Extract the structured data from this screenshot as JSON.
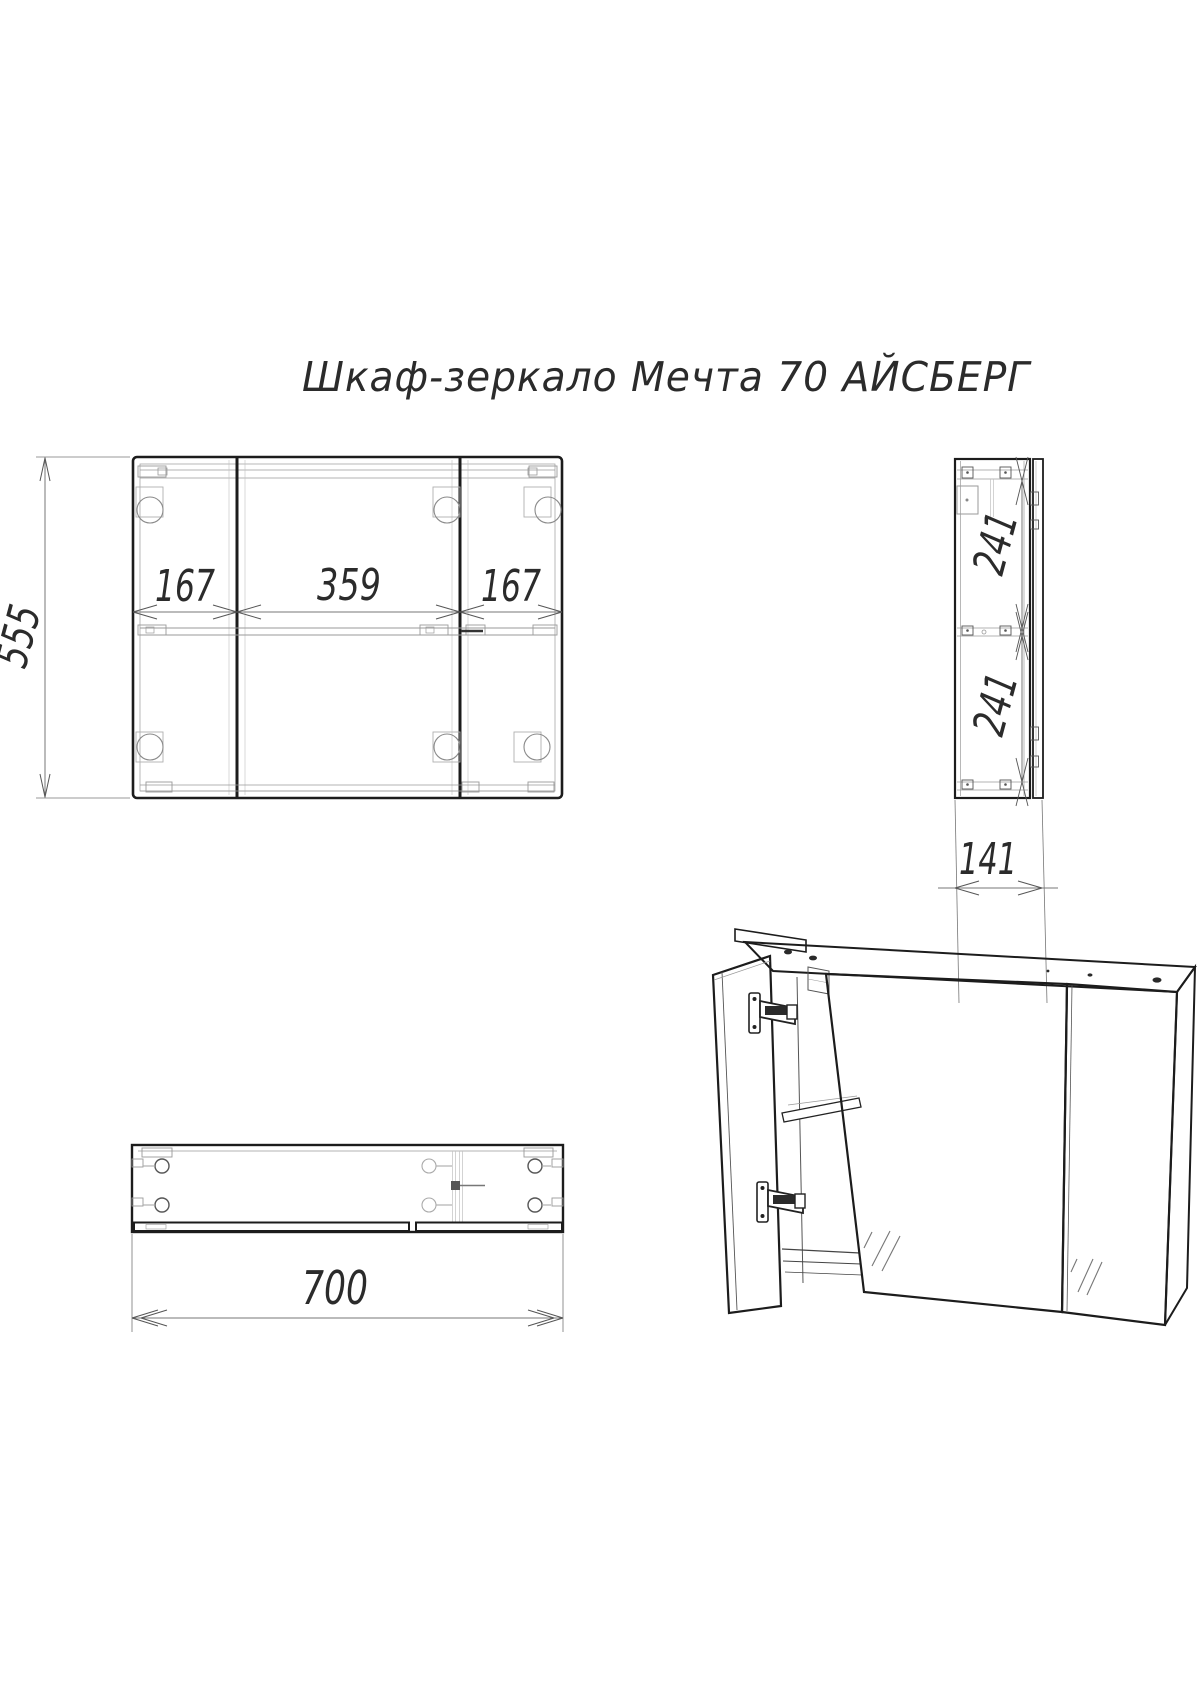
{
  "title": "Шкаф-зеркало Мечта 70  АЙСБЕРГ",
  "drawing_type": "technical-drawing",
  "colors": {
    "ink": "#1c1c1c",
    "dim_line": "#777777",
    "background": "#ffffff"
  },
  "dims": {
    "front_height": "555",
    "front_left_section": "167",
    "front_middle_section": "359",
    "front_right_section": "167",
    "side_upper_section": "241",
    "side_lower_section": "241",
    "side_depth": "141",
    "total_width": "700"
  }
}
